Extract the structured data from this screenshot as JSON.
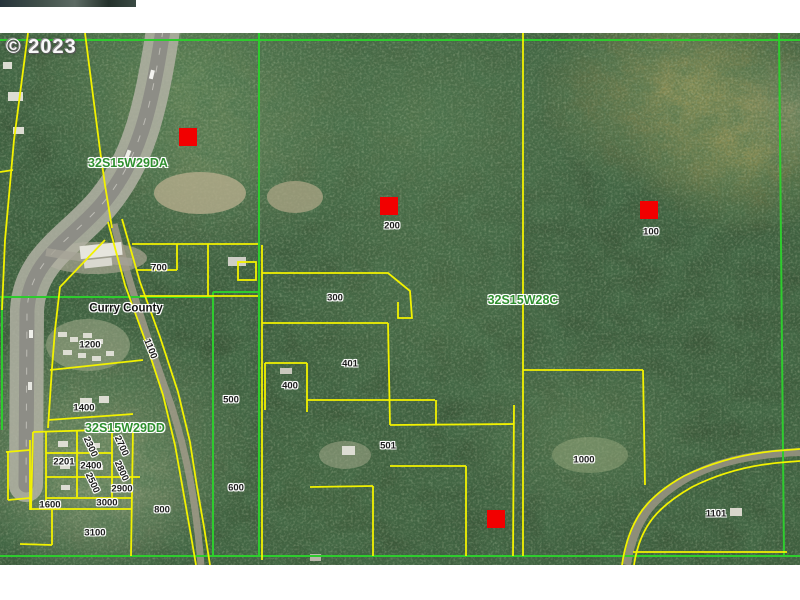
{
  "copyright": "© 2023",
  "map": {
    "county_label": "Curry County",
    "section_labels": [
      {
        "text": "32S15W29DA",
        "x": 128,
        "y": 163
      },
      {
        "text": "32S15W28C",
        "x": 523,
        "y": 300
      },
      {
        "text": "32S15W29DD",
        "x": 125,
        "y": 428
      }
    ],
    "parcel_labels": [
      {
        "text": "700",
        "x": 159,
        "y": 268
      },
      {
        "text": "200",
        "x": 392,
        "y": 226
      },
      {
        "text": "100",
        "x": 651,
        "y": 232
      },
      {
        "text": "300",
        "x": 335,
        "y": 298
      },
      {
        "text": "1200",
        "x": 90,
        "y": 345
      },
      {
        "text": "1100",
        "x": 150,
        "y": 349,
        "rot": 68
      },
      {
        "text": "401",
        "x": 350,
        "y": 364
      },
      {
        "text": "400",
        "x": 290,
        "y": 386
      },
      {
        "text": "500",
        "x": 231,
        "y": 400
      },
      {
        "text": "1400",
        "x": 84,
        "y": 408
      },
      {
        "text": "2300",
        "x": 90,
        "y": 447,
        "rot": 65
      },
      {
        "text": "2700",
        "x": 121,
        "y": 446,
        "rot": 65
      },
      {
        "text": "2201",
        "x": 64,
        "y": 462
      },
      {
        "text": "2400",
        "x": 91,
        "y": 466
      },
      {
        "text": "2800",
        "x": 121,
        "y": 471,
        "rot": 65
      },
      {
        "text": "2500",
        "x": 92,
        "y": 483,
        "rot": 65
      },
      {
        "text": "2900",
        "x": 122,
        "y": 489
      },
      {
        "text": "600",
        "x": 236,
        "y": 488
      },
      {
        "text": "3000",
        "x": 107,
        "y": 503
      },
      {
        "text": "1600",
        "x": 50,
        "y": 505
      },
      {
        "text": "800",
        "x": 162,
        "y": 510
      },
      {
        "text": "3100",
        "x": 95,
        "y": 533
      },
      {
        "text": "501",
        "x": 388,
        "y": 446
      },
      {
        "text": "1000",
        "x": 584,
        "y": 460
      },
      {
        "text": "1101",
        "x": 716,
        "y": 514
      }
    ],
    "markers": [
      {
        "x": 179,
        "y": 128
      },
      {
        "x": 380,
        "y": 197
      },
      {
        "x": 640,
        "y": 201
      },
      {
        "x": 487,
        "y": 510
      }
    ],
    "marker_size": 18,
    "colors": {
      "parcel_line": "#f2f200",
      "section_line": "#2ecc2e",
      "marker": "#f20000",
      "section_text": "#2f8f2f",
      "parcel_text": "#1c1c1c"
    }
  }
}
